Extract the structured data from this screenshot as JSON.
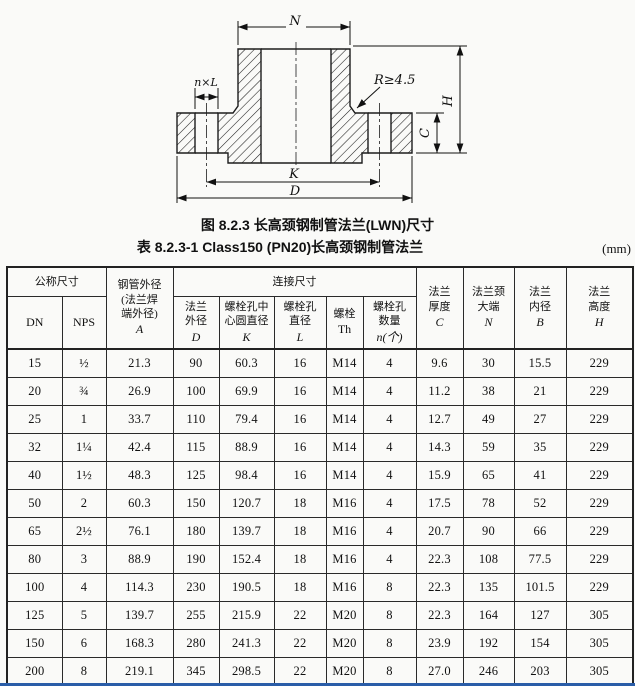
{
  "figure": {
    "caption": "图 8.2.3  长高颈钢制管法兰(LWN)尺寸",
    "dimension_labels": {
      "neck_top": "N",
      "bolt_holes": "n×L",
      "fillet_radius": "R≥4.5",
      "flange_height": "H",
      "flange_thickness": "C",
      "bolt_circle": "K",
      "outer_diameter": "D"
    }
  },
  "table": {
    "caption": "表 8.2.3-1  Class150 (PN20)长高颈钢制管法兰",
    "unit": "(mm)",
    "group_headers": {
      "nominal_size": "公称尺寸",
      "connection_dims": "连接尺寸"
    },
    "columns": [
      {
        "cn": "",
        "sym": "DN"
      },
      {
        "cn": "",
        "sym": "NPS"
      },
      {
        "cn": "钢管外径\n(法兰焊\n端外径)",
        "sym": "A"
      },
      {
        "cn": "法兰\n外径",
        "sym": "D"
      },
      {
        "cn": "螺栓孔中\n心圆直径",
        "sym": "K"
      },
      {
        "cn": "螺栓孔\n直径",
        "sym": "L"
      },
      {
        "cn": "螺栓",
        "sym": "Th"
      },
      {
        "cn": "螺栓孔\n数量",
        "sym": "n(个)"
      },
      {
        "cn": "法兰\n厚度",
        "sym": "C"
      },
      {
        "cn": "法兰颈\n大端",
        "sym": "N"
      },
      {
        "cn": "法兰\n内径",
        "sym": "B"
      },
      {
        "cn": "法兰\n高度",
        "sym": "H"
      }
    ],
    "rows": [
      [
        "15",
        "½",
        "21.3",
        "90",
        "60.3",
        "16",
        "M14",
        "4",
        "9.6",
        "30",
        "15.5",
        "229"
      ],
      [
        "20",
        "¾",
        "26.9",
        "100",
        "69.9",
        "16",
        "M14",
        "4",
        "11.2",
        "38",
        "21",
        "229"
      ],
      [
        "25",
        "1",
        "33.7",
        "110",
        "79.4",
        "16",
        "M14",
        "4",
        "12.7",
        "49",
        "27",
        "229"
      ],
      [
        "32",
        "1¼",
        "42.4",
        "115",
        "88.9",
        "16",
        "M14",
        "4",
        "14.3",
        "59",
        "35",
        "229"
      ],
      [
        "40",
        "1½",
        "48.3",
        "125",
        "98.4",
        "16",
        "M14",
        "4",
        "15.9",
        "65",
        "41",
        "229"
      ],
      [
        "50",
        "2",
        "60.3",
        "150",
        "120.7",
        "18",
        "M16",
        "4",
        "17.5",
        "78",
        "52",
        "229"
      ],
      [
        "65",
        "2½",
        "76.1",
        "180",
        "139.7",
        "18",
        "M16",
        "4",
        "20.7",
        "90",
        "66",
        "229"
      ],
      [
        "80",
        "3",
        "88.9",
        "190",
        "152.4",
        "18",
        "M16",
        "4",
        "22.3",
        "108",
        "77.5",
        "229"
      ],
      [
        "100",
        "4",
        "114.3",
        "230",
        "190.5",
        "18",
        "M16",
        "8",
        "22.3",
        "135",
        "101.5",
        "229"
      ],
      [
        "125",
        "5",
        "139.7",
        "255",
        "215.9",
        "22",
        "M20",
        "8",
        "22.3",
        "164",
        "127",
        "305"
      ],
      [
        "150",
        "6",
        "168.3",
        "280",
        "241.3",
        "22",
        "M20",
        "8",
        "23.9",
        "192",
        "154",
        "305"
      ],
      [
        "200",
        "8",
        "219.1",
        "345",
        "298.5",
        "22",
        "M20",
        "8",
        "27.0",
        "246",
        "203",
        "305"
      ],
      [
        "250",
        "10",
        "273",
        "405",
        "362.0",
        "26",
        "M24",
        "12",
        "28.6",
        "305",
        "255",
        "305"
      ]
    ]
  }
}
